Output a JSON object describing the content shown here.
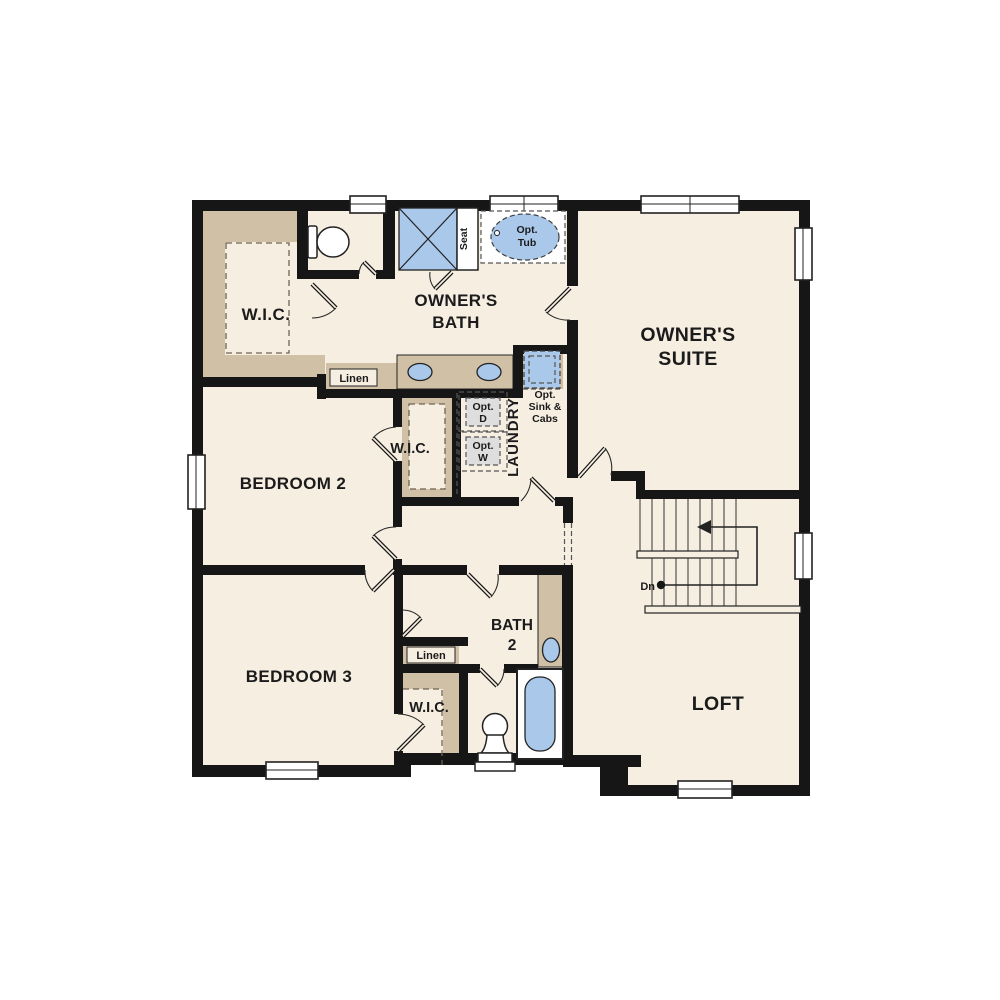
{
  "page": {
    "description": "Second story residential floor plan drawing",
    "background": "#ffffff"
  },
  "colors": {
    "wall": "#161616",
    "floor": "#f6eee1",
    "cabinetry_tan": "#cfc0a6",
    "fixture_blue": "#aac9ea",
    "optional_gray": "#dedede"
  },
  "labels": {
    "owners_wic": "W.I.C.",
    "owners_bath": [
      "OWNER'S",
      "BATH"
    ],
    "seat": "Seat",
    "opt_tub": [
      "Opt.",
      "Tub"
    ],
    "owners_suite": [
      "OWNER'S",
      "SUITE"
    ],
    "linen_upper": "Linen",
    "bedroom2": "BEDROOM 2",
    "bedroom2_wic": "W.I.C.",
    "laundry": "LAUNDRY",
    "opt_dryer": [
      "Opt.",
      "D"
    ],
    "opt_washer": [
      "Opt.",
      "W"
    ],
    "opt_sink": [
      "Opt.",
      "Sink &",
      "Cabs"
    ],
    "stairs_down": "Dn",
    "bedroom3": "BEDROOM 3",
    "linen_lower": "Linen",
    "bedroom3_wic": "W.I.C.",
    "bath2": [
      "BATH",
      "2"
    ],
    "loft": "LOFT"
  }
}
